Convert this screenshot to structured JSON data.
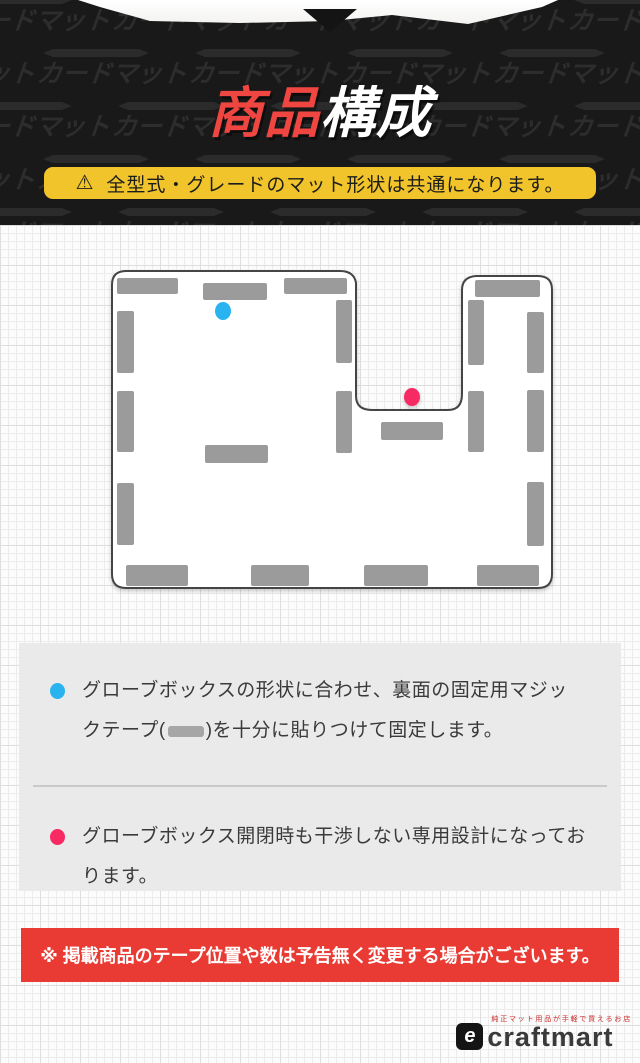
{
  "header": {
    "watermark_word": "カードマット",
    "title_red": "商品",
    "title_white": "構成",
    "warning_icon": "⚠",
    "warning_text": "全型式・グレードのマット形状は共通になります。"
  },
  "colors": {
    "title_red": "#ef4641",
    "warning_bg": "#f0c42a",
    "notice_bg": "#e93a33",
    "marker_blue": "#29b3ef",
    "marker_pink": "#f72a64",
    "tape_gray": "#9b9b9b"
  },
  "diagram": {
    "type": "floor-mat-schematic",
    "mat_fill": "#ffffff",
    "outline_color": "#454545",
    "tape_color": "#9b9b9b",
    "mat_path": "M 126 46 L 340 46 Q 354 46 356 58 L 356 171 Q 356 185 372 185 L 448 185 Q 462 185 462 169 L 462 65 Q 462 52 476 51 L 538 51 Q 552 51 552 65 L 552 349 Q 552 363 538 363 L 126 363 Q 112 363 112 349 L 112 60 Q 112 46 126 46 Z",
    "tapes": [
      [
        117,
        53,
        61,
        16
      ],
      [
        203,
        58,
        64,
        17
      ],
      [
        284,
        53,
        63,
        16
      ],
      [
        117,
        86,
        17,
        62
      ],
      [
        117,
        166,
        17,
        61
      ],
      [
        117,
        258,
        17,
        62
      ],
      [
        336,
        75,
        16,
        63
      ],
      [
        336,
        166,
        16,
        62
      ],
      [
        205,
        220,
        63,
        18
      ],
      [
        381,
        197,
        62,
        18
      ],
      [
        475,
        55,
        65,
        17
      ],
      [
        468,
        75,
        16,
        65
      ],
      [
        468,
        166,
        16,
        61
      ],
      [
        527,
        87,
        17,
        61
      ],
      [
        527,
        165,
        17,
        62
      ],
      [
        527,
        257,
        17,
        64
      ],
      [
        126,
        340,
        62,
        21
      ],
      [
        251,
        340,
        58,
        21
      ],
      [
        364,
        340,
        64,
        21
      ],
      [
        477,
        340,
        62,
        21
      ]
    ],
    "markers": [
      {
        "name": "glovebox-fix-point",
        "color": "#29b3ef",
        "x": 223,
        "y": 86
      },
      {
        "name": "glovebox-clearance-point",
        "color": "#f72a64",
        "x": 412,
        "y": 172
      }
    ]
  },
  "notes": {
    "items": [
      {
        "bullet_color": "#29b3ef",
        "text_before": "グローブボックスの形状に合わせ、裏面の固定用マジックテープ(",
        "text_after": ")を十分に貼りつけて固定します。"
      },
      {
        "bullet_color": "#f72a64",
        "text": "グローブボックス開閉時も干渉しない専用設計になっております。"
      }
    ]
  },
  "footer_notice": "※ 掲載商品のテープ位置や数は予告無く変更する場合がございます。",
  "brand": {
    "logo_text": "craftmart",
    "logo_icon": "e",
    "tagline": "純正マット用品が手軽で買えるお店"
  }
}
